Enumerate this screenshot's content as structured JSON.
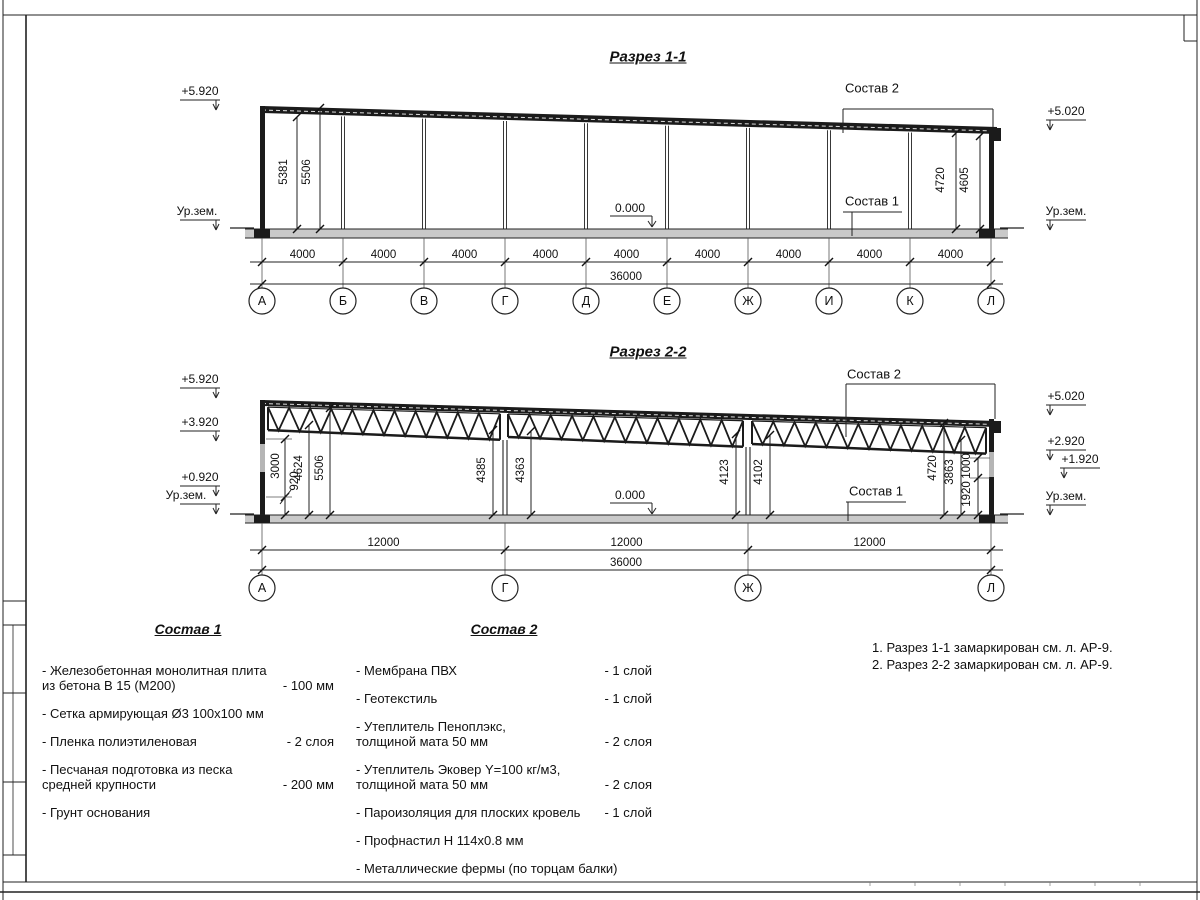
{
  "sections": [
    {
      "id": "sec1",
      "title": "Разрез 1-1",
      "zero_mark": "0.000",
      "callouts": {
        "roof": "Состав 2",
        "floor": "Состав 1"
      },
      "marks_left": [
        "+5.920",
        "Ур.зем."
      ],
      "marks_right": [
        "+5.020",
        "Ур.зем."
      ],
      "vdims": [
        "5381",
        "5506",
        "4720",
        "4605"
      ],
      "span_labels": [
        "4000",
        "4000",
        "4000",
        "4000",
        "4000",
        "4000",
        "4000",
        "4000",
        "4000"
      ],
      "total": "36000",
      "axes": [
        "А",
        "Б",
        "В",
        "Г",
        "Д",
        "Е",
        "Ж",
        "И",
        "К",
        "Л"
      ]
    },
    {
      "id": "sec2",
      "title": "Разрез 2-2",
      "zero_mark": "0.000",
      "callouts": {
        "roof": "Состав 2",
        "floor": "Состав 1"
      },
      "marks_left": [
        "+5.920",
        "+3.920",
        "+0.920",
        "Ур.зем."
      ],
      "marks_right": [
        "+5.020",
        "+2.920",
        "+1.920",
        "Ур.зем."
      ],
      "vdims": [
        "3000",
        "920",
        "4624",
        "5506",
        "4385",
        "4363",
        "4123",
        "4102",
        "4720",
        "3863",
        "1000",
        "1920"
      ],
      "span_labels": [
        "12000",
        "12000",
        "12000"
      ],
      "total": "36000",
      "axes": [
        "А",
        "Г",
        "Ж",
        "Л"
      ]
    }
  ],
  "legend": {
    "comp1": {
      "title": "Состав 1",
      "items": [
        {
          "name": "- Железобетонная  монолитная плита\nиз бетона В 15 (М200)",
          "qty": "- 100 мм"
        },
        {
          "name": "- Сетка армирующая Ø3 100х100 мм",
          "qty": ""
        },
        {
          "name": "- Пленка полиэтиленовая",
          "qty": "-  2 слоя"
        },
        {
          "name": "- Песчаная подготовка из песка\nсредней крупности",
          "qty": "- 200 мм"
        },
        {
          "name": "- Грунт основания",
          "qty": ""
        }
      ]
    },
    "comp2": {
      "title": "Состав 2",
      "items": [
        {
          "name": "- Мембрана ПВХ",
          "qty": "- 1 слой"
        },
        {
          "name": "- Геотекстиль",
          "qty": "- 1 слой"
        },
        {
          "name": "- Утеплитель Пеноплэкс,\nтолщиной мата 50 мм",
          "qty": "- 2 слоя"
        },
        {
          "name": "- Утеплитель Эковер Y=100 кг/м3,\nтолщиной мата 50 мм",
          "qty": "- 2 слоя"
        },
        {
          "name": "- Пароизоляция для плоских кровель",
          "qty": "- 1 слой"
        },
        {
          "name": "- Профнастил Н 114х0.8 мм",
          "qty": ""
        },
        {
          "name": "- Металлические фермы (по торцам балки)",
          "qty": ""
        }
      ]
    }
  },
  "notes": [
    "1. Разрез 1-1 замаркирован см. л. АР-9.",
    "2. Разрез 2-2 замаркирован см. л. АР-9."
  ],
  "colors": {
    "line": "#222222",
    "dark": "#1b1b1b",
    "floor_fill": "#c9c9c9",
    "wall_gap": "#b5b5b5"
  }
}
